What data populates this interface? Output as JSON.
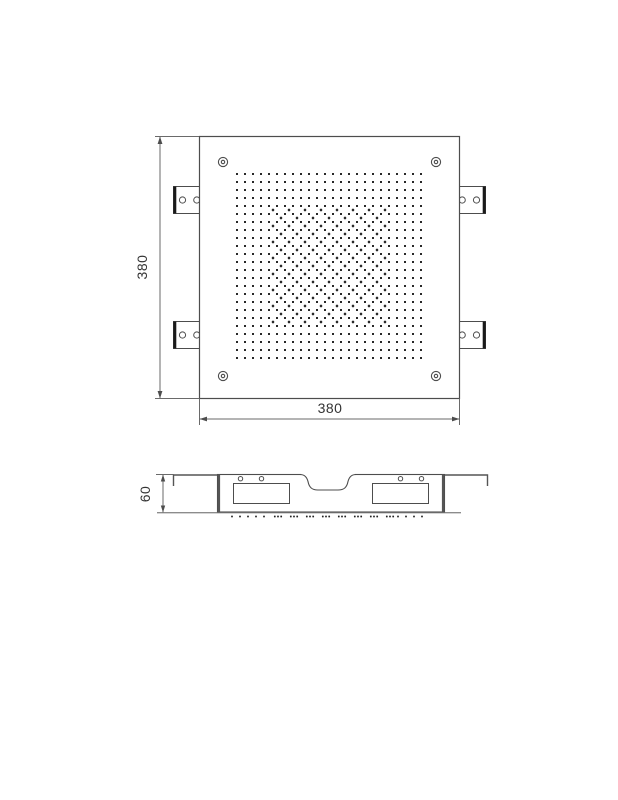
{
  "drawing": {
    "kind": "technical-drawing",
    "subject": "square recessed shower head panel",
    "colors": {
      "line": "#4d4d4d",
      "thin_line": "#6a6a6a",
      "thick_edge": "#1a1a1a",
      "dot": "#1c1c1c",
      "plate_line": "#8c8c8c",
      "text": "#333333",
      "background": "#ffffff"
    },
    "views": {
      "top": {
        "name": "plan-view",
        "width_label": "380",
        "height_label": "380",
        "nozzle_grid": {
          "origin_x": 237,
          "origin_y": 174,
          "cols": 24,
          "rows": 24,
          "spacing": 8,
          "dot_size": 2
        },
        "accent_dots": {
          "rule": "half-offset-checkerboard",
          "i_min": 4,
          "i_max": 18,
          "j_min": 4,
          "j_max": 18,
          "offset_x": 241,
          "offset_y": 178,
          "spacing": 8,
          "dot_size": 2.4
        }
      },
      "side": {
        "name": "profile-view",
        "height_label": "60",
        "spray_row": {
          "y": 516.5,
          "dot_size": 1.7,
          "single_start_x": 232,
          "single_step": 8,
          "singles_left": 5,
          "cluster_start_x": 278,
          "cluster_step": 16,
          "clusters": 8,
          "cluster_dot_gap": 3.2,
          "singles_right_start_x": 398,
          "singles_right": 4
        }
      }
    }
  }
}
